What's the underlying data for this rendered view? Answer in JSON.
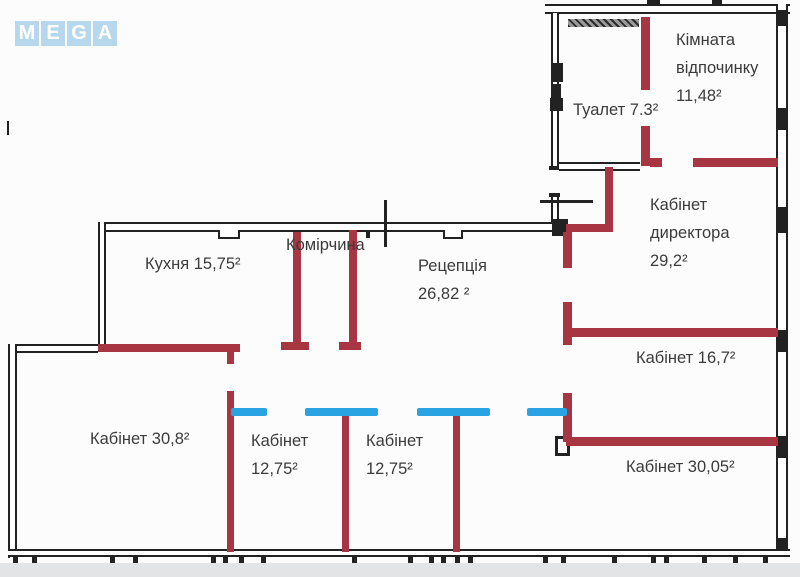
{
  "colors": {
    "background": "#fcfcfc",
    "wall_black": "#222222",
    "wall_red": "#a73642",
    "partition_blue": "#2aa3e2",
    "label_color": "#3b3b3b",
    "logo_tile": "#b7d8ec",
    "logo_letter": "#ffffff",
    "footer_strip": "#e3e4e6"
  },
  "logo": {
    "letters": [
      "M",
      "E",
      "G",
      "A"
    ]
  },
  "rooms": [
    {
      "id": "rest-room",
      "name": "Кімната відпочинку",
      "area": "11,48",
      "lines": [
        "Кімната",
        "відпочинку",
        "11,48²"
      ]
    },
    {
      "id": "toilet",
      "name": "Туалет",
      "area": "7.3",
      "lines": [
        "Туалет 7.3²"
      ]
    },
    {
      "id": "director-office",
      "name": "Кабінет директора",
      "area": "29,2",
      "lines": [
        "Кабінет",
        "директора",
        "29,2²"
      ]
    },
    {
      "id": "kitchen",
      "name": "Кухня",
      "area": "15,75",
      "lines": [
        "Кухня 15,75²"
      ]
    },
    {
      "id": "pantry",
      "name": "Комірчина",
      "area": "",
      "lines": [
        "Комірчина"
      ]
    },
    {
      "id": "reception",
      "name": "Рецепція",
      "area": "26,82",
      "lines": [
        "Рецепція",
        "26,82 ²"
      ]
    },
    {
      "id": "office-16-7",
      "name": "Кабінет",
      "area": "16,7",
      "lines": [
        "Кабінет 16,7²"
      ]
    },
    {
      "id": "office-30-8",
      "name": "Кабінет",
      "area": "30,8",
      "lines": [
        "Кабінет 30,8²"
      ]
    },
    {
      "id": "office-12-75-a",
      "name": "Кабінет",
      "area": "12,75",
      "lines": [
        "Кабінет",
        "12,75²"
      ]
    },
    {
      "id": "office-12-75-b",
      "name": "Кабінет",
      "area": "12,75",
      "lines": [
        "Кабінет",
        "12,75²"
      ]
    },
    {
      "id": "office-30-05",
      "name": "Кабінет",
      "area": "30,05",
      "lines": [
        "Кабінет 30,05²"
      ]
    }
  ]
}
